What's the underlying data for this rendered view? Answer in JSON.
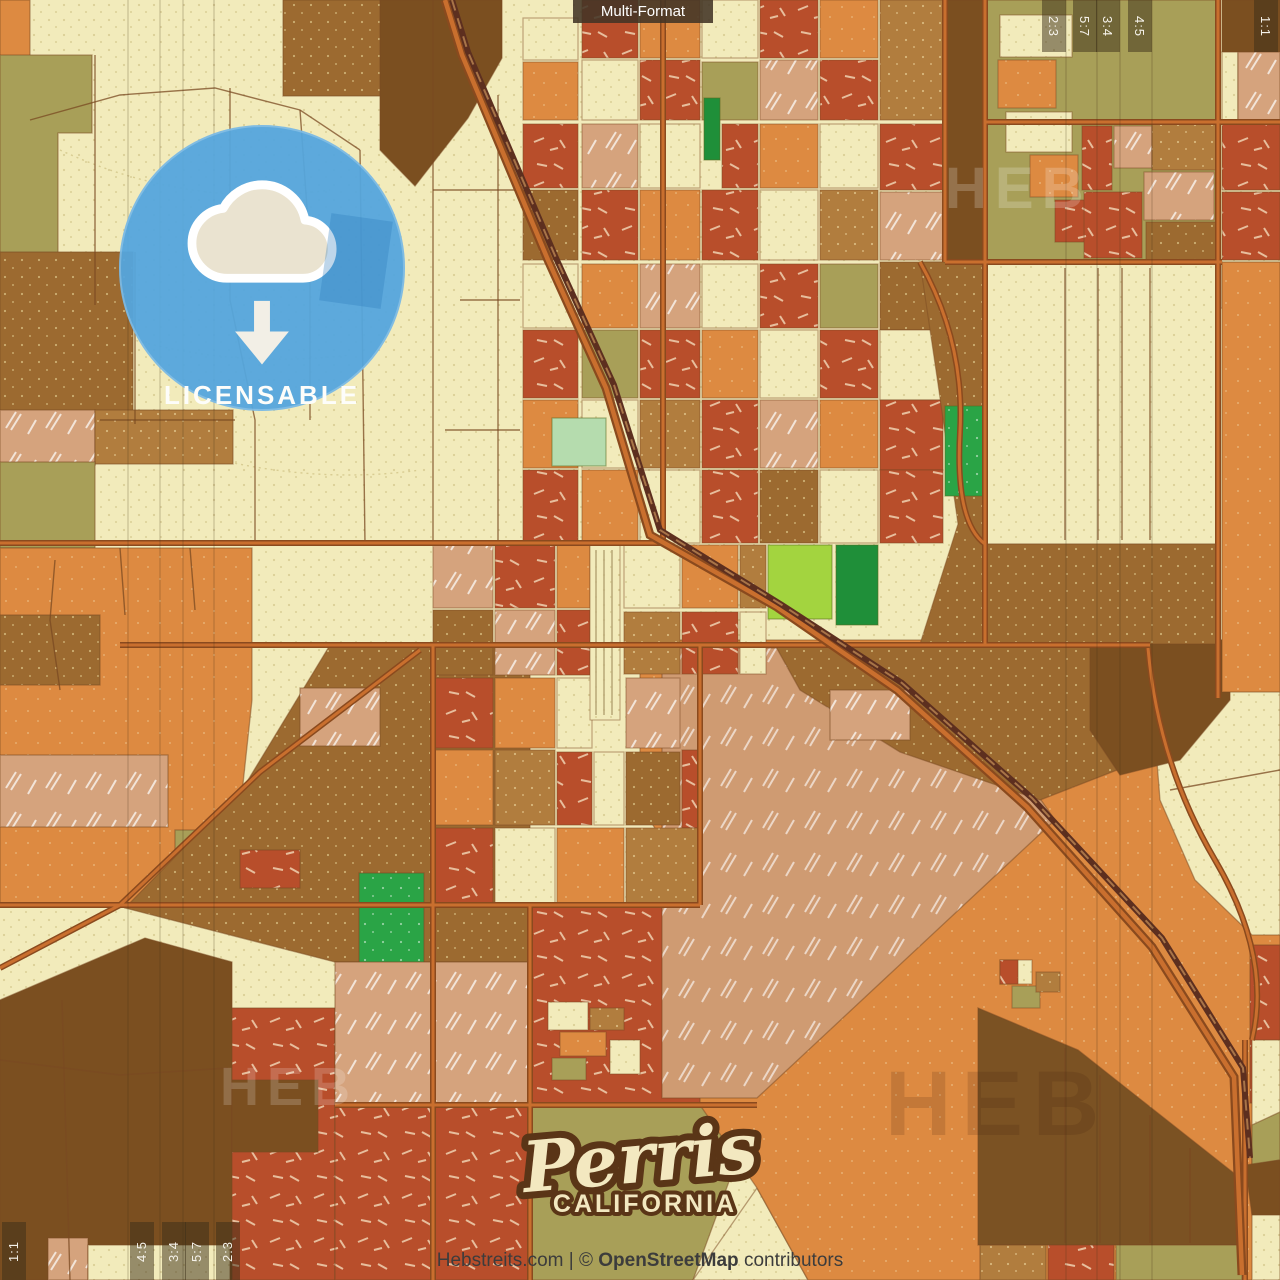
{
  "overlay": {
    "multi_format_label": "Multi-Format",
    "badge": {
      "label": "LICENSABLE",
      "icon": "cloud-download-icon"
    },
    "crop_marks": {
      "top_right": [
        {
          "label": "2:3"
        },
        {
          "label": "5:7"
        },
        {
          "label": "3:4"
        },
        {
          "label": "4:5"
        },
        {
          "label": "1:1"
        }
      ],
      "bottom_left": [
        {
          "label": "1:1"
        },
        {
          "label": "4:5"
        },
        {
          "label": "3:4"
        },
        {
          "label": "5:7"
        },
        {
          "label": "2:3"
        }
      ]
    }
  },
  "map": {
    "city": "Perris",
    "state": "CALIFORNIA",
    "watermark": "HEB"
  },
  "footer": {
    "site": "Hebstreits.com",
    "separator": "|",
    "copyright": "©",
    "attribution_name": "OpenStreetMap",
    "attribution_suffix": "contributors"
  },
  "palette": {
    "cream": "#f2ebbd",
    "orange": "#dd8a41",
    "brick_red": "#b84e2b",
    "salmon": "#d5a37d",
    "olive": "#a89f58",
    "brown": "#9c6a30",
    "tan": "#b17d3e",
    "dark_brown": "#7b4f20",
    "green": "#2aa446",
    "dark_green": "#1f8f39",
    "pale_green": "#b5dcae",
    "yellow_green": "#a3d43f",
    "badge_blue": "#54a5dd",
    "road": "#7a4a22",
    "railway": "#5d2f1f",
    "highway_orange": "#c96f2e",
    "logo_cream": "#f3e8c0",
    "logo_outline": "#5a3517"
  }
}
